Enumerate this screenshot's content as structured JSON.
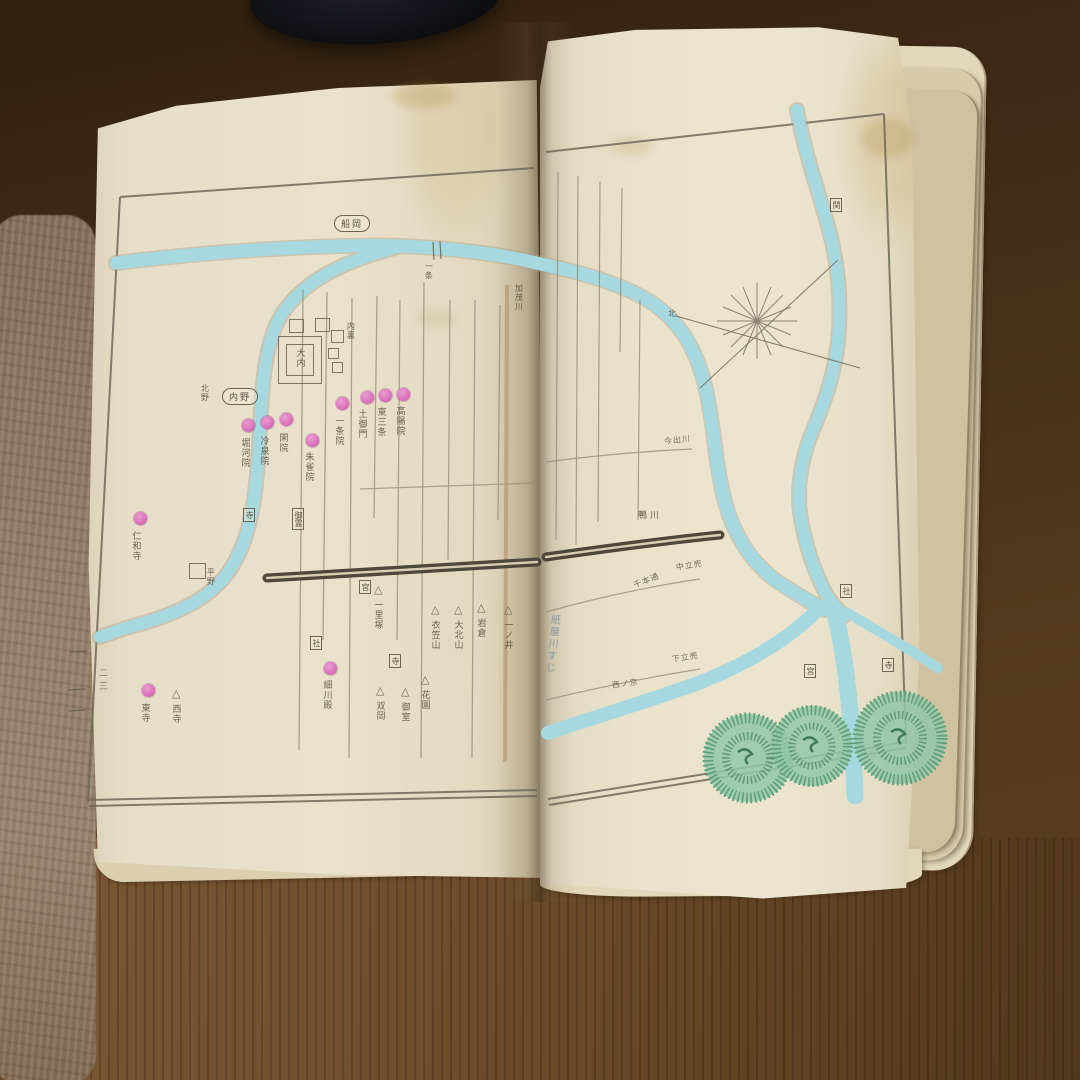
{
  "scene": {
    "description": "Open antique Japanese map book (hand-coloured woodblock atlas of the Kyoto / Heian capital) lying on a dark wooden table",
    "page_edge_number": "二三"
  },
  "palette": {
    "paper": "#eae1cc",
    "river_blue": "#a6d9df",
    "marker_pink": "#dc74bd",
    "tree_green": "#7fbd9c",
    "ink": "#4c4737",
    "table_dark": "#3e2a15",
    "table_light": "#6f4e2c"
  },
  "left_page": {
    "cartouches": [
      {
        "text": "船岡"
      },
      {
        "text": "内野"
      }
    ],
    "palace_label": "大内",
    "circles": [
      {
        "label": "堀河院"
      },
      {
        "label": "冷泉院"
      },
      {
        "label": "閑院"
      },
      {
        "label": "朱雀院"
      },
      {
        "label": "一条院"
      },
      {
        "label": "土御門"
      },
      {
        "label": "東三条"
      },
      {
        "label": "高陽院"
      },
      {
        "label": "仁和寺"
      },
      {
        "label": "細川殿"
      },
      {
        "label": "東寺"
      }
    ],
    "triangles": [
      {
        "label": "一里塚"
      },
      {
        "label": "衣笠山"
      },
      {
        "label": "大北山"
      },
      {
        "label": "岩倉"
      },
      {
        "label": "花園"
      },
      {
        "label": "御室"
      },
      {
        "label": "双岡"
      },
      {
        "label": "西寺"
      }
    ],
    "boxes": [
      {
        "text": "寺"
      },
      {
        "text": "御霊"
      },
      {
        "text": "宮"
      },
      {
        "text": "社"
      },
      {
        "text": "寺"
      }
    ],
    "labels": [
      {
        "text": "一条"
      },
      {
        "text": "加茂川"
      },
      {
        "text": "内裏"
      },
      {
        "text": "北野"
      },
      {
        "text": "平野"
      }
    ]
  },
  "right_page": {
    "river_label": "鴨川",
    "compass_label": "北",
    "handwriting": "紙屋川すじ",
    "triangles": [
      {
        "label": "一ノ井"
      }
    ],
    "boxes": [
      {
        "text": "関"
      },
      {
        "text": "社"
      },
      {
        "text": "宮"
      },
      {
        "text": "寺"
      }
    ],
    "street_labels": [
      {
        "text": "今出川"
      },
      {
        "text": "中立売"
      },
      {
        "text": "下立売"
      },
      {
        "text": "千本通"
      },
      {
        "text": "西ノ京"
      }
    ]
  }
}
